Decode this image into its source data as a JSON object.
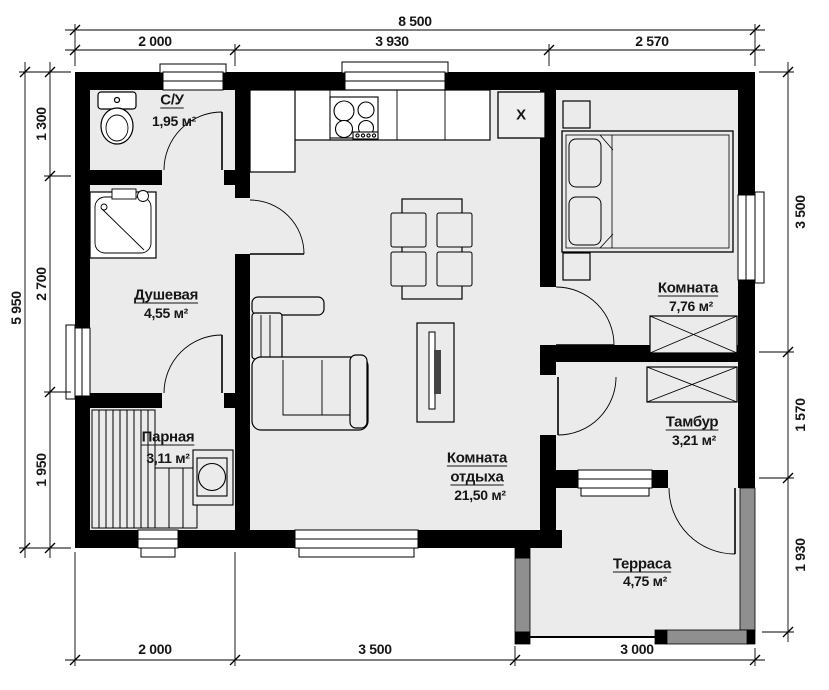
{
  "plan": {
    "dimensions": {
      "top_total": "8 500",
      "top_segments": [
        "2 000",
        "3 930",
        "2 570"
      ],
      "left_total": "5 950",
      "left_segments": [
        "1 300",
        "2 700",
        "1 950"
      ],
      "right_segments": [
        "3 500",
        "1 570",
        "1 930"
      ],
      "bottom_segments": [
        "2 000",
        "3 500",
        "3 000"
      ]
    },
    "rooms": {
      "wc": {
        "name": "С/У",
        "area": "1,95 м²"
      },
      "shower": {
        "name": "Душевая",
        "area": "4,55 м²"
      },
      "steam": {
        "name": "Парная",
        "area": "3,11 м²"
      },
      "lounge": {
        "name_line1": "Комната",
        "name_line2": "отдыха",
        "area": "21,50 м²"
      },
      "bedroom": {
        "name": "Комната",
        "area": "7,76 м²"
      },
      "vestibule": {
        "name": "Тамбур",
        "area": "3,21 м²"
      },
      "terrace": {
        "name": "Терраса",
        "area": "4,75 м²"
      }
    },
    "equipment": {
      "boiler_label": "X"
    }
  }
}
